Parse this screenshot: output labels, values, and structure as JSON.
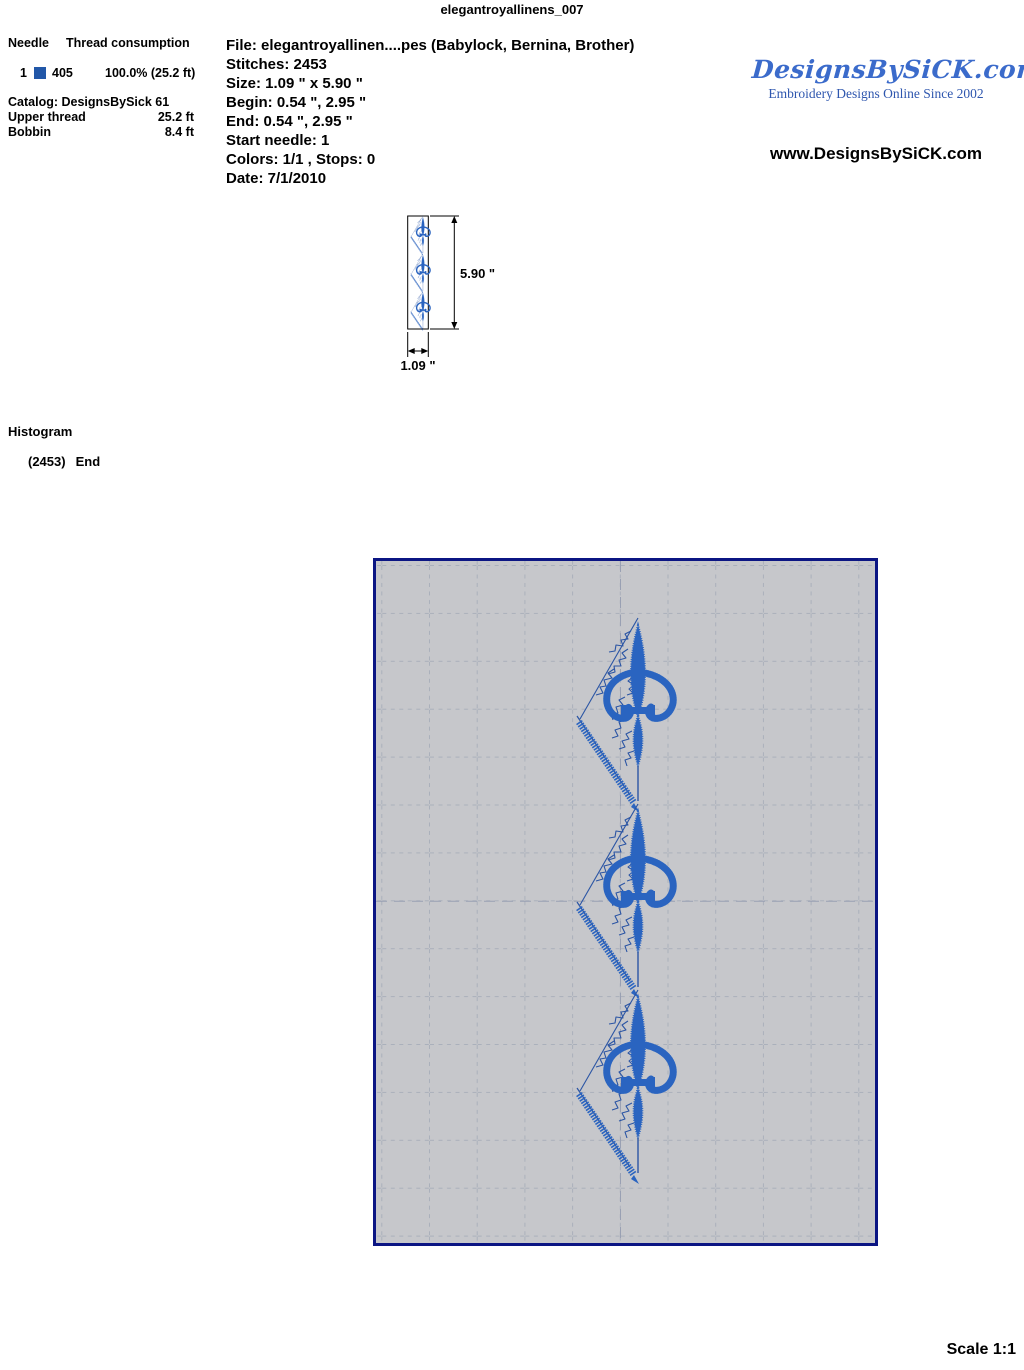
{
  "title": "elegantroyallinens_007",
  "needle_panel": {
    "header_needle": "Needle",
    "header_consumption": "Thread consumption",
    "row": {
      "num": "1",
      "code": "405",
      "usage": "100.0% (25.2 ft)",
      "swatch_color": "#2257a8"
    },
    "catalog": "Catalog: DesignsBySick 61",
    "upper_label": "Upper thread",
    "upper_value": "25.2 ft",
    "bobbin_label": "Bobbin",
    "bobbin_value": "8.4 ft"
  },
  "file_info": {
    "file": "File: elegantroyallinen....pes  (Babylock, Bernina, Brother)",
    "stitches": "Stitches: 2453",
    "size": "Size: 1.09 \" x 5.90 \"",
    "begin": "Begin: 0.54 \", 2.95 \"",
    "end": "End: 0.54 \", 2.95 \"",
    "start_needle": "Start needle: 1",
    "colors": "Colors: 1/1 , Stops: 0",
    "date": "Date: 7/1/2010"
  },
  "branding": {
    "logo": "DesignsBySiCK.com",
    "tagline": "Embroidery Designs Online Since 2002",
    "url": "www.DesignsBySiCK.com"
  },
  "dimensions": {
    "height_label": "5.90 \"",
    "width_label": "1.09 \""
  },
  "histogram": {
    "heading": "Histogram",
    "count": "(2453)",
    "label": "End"
  },
  "scale_label": "Scale 1:1",
  "design": {
    "motif": "fleur-de-lis triangle border, repeated 3 times vertically",
    "stitch_color": "#2a64c0",
    "outline_color": "#2b55a4",
    "preview_background": "#c6c7cb",
    "preview_border": "#0b1583",
    "grid_color": "#aab0bb"
  }
}
